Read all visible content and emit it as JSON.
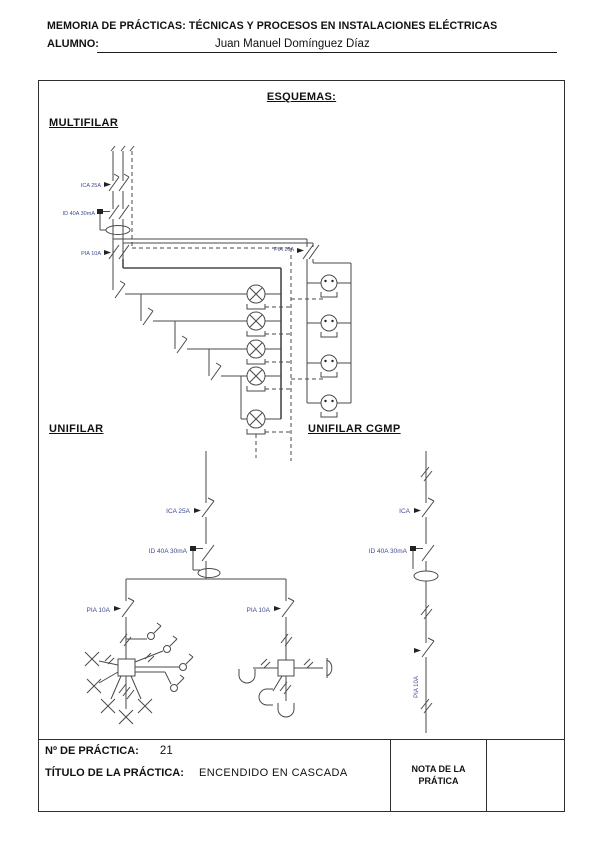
{
  "header": {
    "title": "MEMORIA DE PRÁCTICAS: TÉCNICAS Y PROCESOS EN INSTALACIONES ELÉCTRICAS",
    "student_label": "ALUMNO:",
    "student_name": "Juan Manuel Domínguez Díaz"
  },
  "schematics": {
    "section_title": "ESQUEMAS:",
    "multifilar": {
      "heading": "MULTIFILAR",
      "labels": {
        "main_breaker": "ICA 25A",
        "differential": "ID 40A 30mA",
        "lighting_breaker": "PIA 10A",
        "socket_breaker": "PIA 16A"
      }
    },
    "unifilar": {
      "heading": "UNIFILAR",
      "labels": {
        "main_breaker": "ICA 25A",
        "differential": "ID 40A 30mA",
        "left_branch_breaker": "PIA 10A",
        "right_branch_breaker": "PIA 10A"
      }
    },
    "unifilar_cgmp": {
      "heading": "UNIFILAR CGMP",
      "labels": {
        "main_breaker": "ICA",
        "differential": "ID 40A 30mA",
        "branch_breaker": "PIA 10A"
      }
    }
  },
  "footer": {
    "practice_number_label": "Nº DE PRÁCTICA:",
    "practice_number": "21",
    "practice_title_label": "TÍTULO DE LA PRÁCTICA:",
    "practice_title": "ENCENDIDO EN CASCADA",
    "grade_label_line1": "NOTA DE LA",
    "grade_label_line2": "PRÁTICA"
  }
}
